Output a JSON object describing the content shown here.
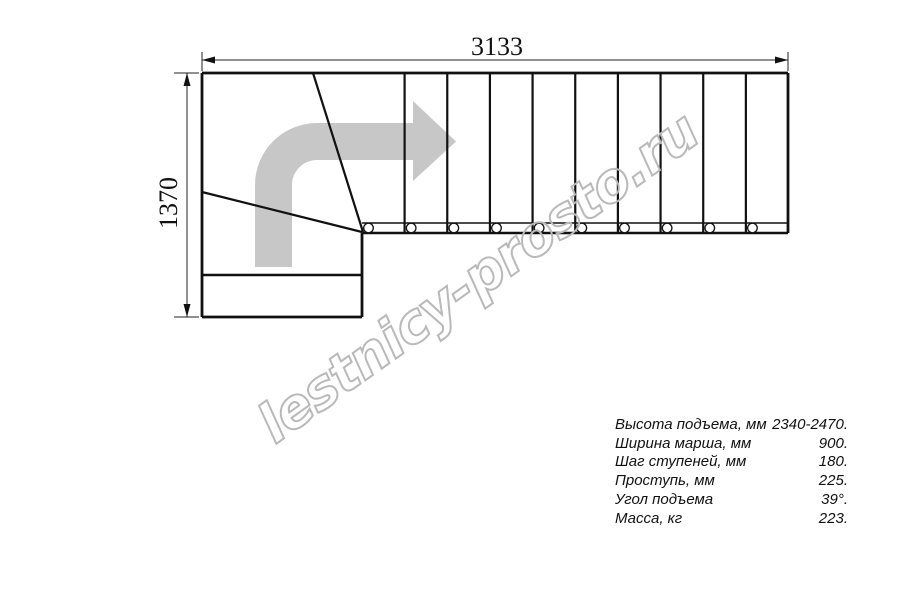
{
  "dimensions": {
    "width_mm": "3133",
    "height_mm": "1370"
  },
  "specs": {
    "rows": [
      {
        "label": "Высота подъема, мм",
        "value": "2340-2470."
      },
      {
        "label": "Ширина марша, мм",
        "value": "900."
      },
      {
        "label": "Шаг ступеней, мм",
        "value": "180."
      },
      {
        "label": "Проступь, мм",
        "value": "225."
      },
      {
        "label": "Угол подъема",
        "value": "39°."
      },
      {
        "label": "Масса, кг",
        "value": "223."
      }
    ]
  },
  "watermark": {
    "text": "lestnicy-prosto.ru",
    "color": "#b9b9b9"
  },
  "plan": {
    "colors": {
      "line": "#111111",
      "arrow": "#c7c7c7"
    },
    "straight_treads": {
      "count": 9,
      "first_x": 404.6,
      "spacing": 42.66,
      "top_y": 73,
      "bottom_y": 232.5
    },
    "balusters": {
      "count": 10,
      "first_x": 368.5,
      "spacing": 42.66,
      "cy": 228,
      "r": 4.8
    }
  }
}
